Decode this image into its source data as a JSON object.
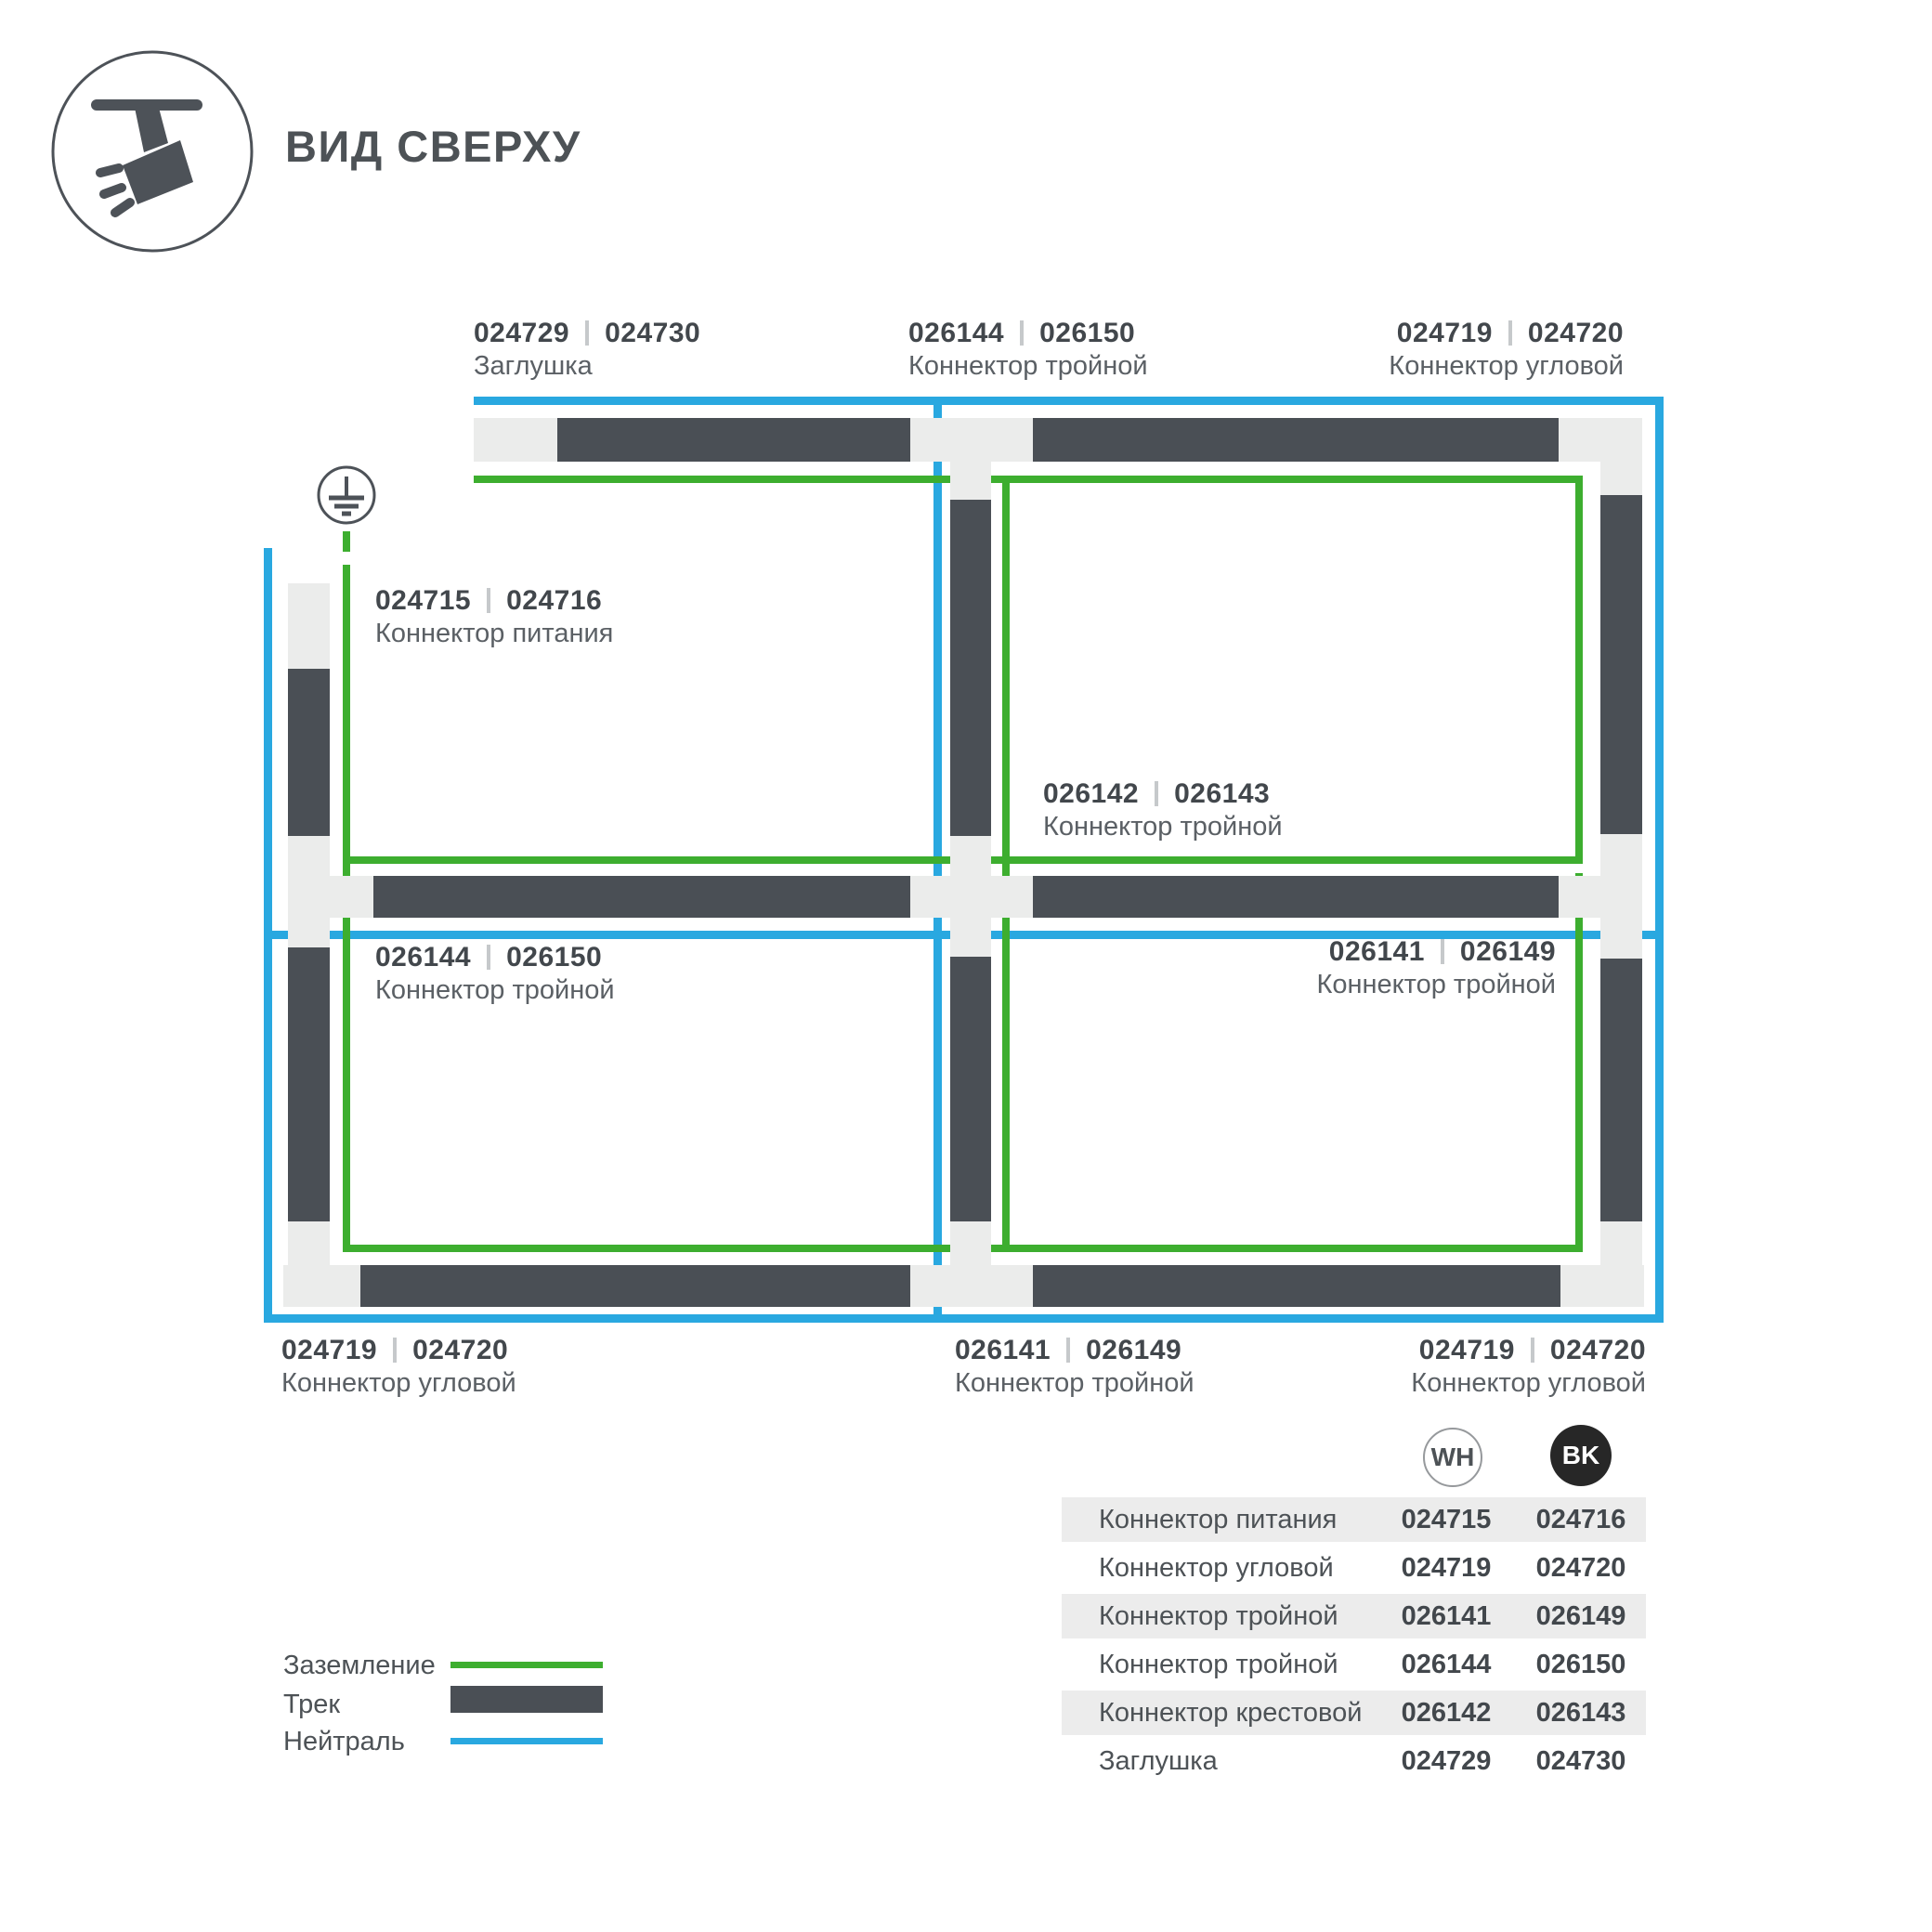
{
  "header": {
    "title": "ВИД СВЕРХУ"
  },
  "colors": {
    "blue": "#29a8e0",
    "green": "#3dae2f",
    "tdark": "#4a4f55",
    "tlight": "#ebeceb",
    "ink": "#4d5256",
    "code": "#42474c",
    "muted": "#5b6065",
    "sep": "#c6c9cb",
    "rowbg": "#ececec",
    "bk": "#272727"
  },
  "diagram": {
    "labels": [
      {
        "wh": "024729",
        "bk": "024730",
        "name": "Заглушка"
      },
      {
        "wh": "026144",
        "bk": "026150",
        "name": "Коннектор тройной"
      },
      {
        "wh": "024719",
        "bk": "024720",
        "name": "Коннектор угловой"
      },
      {
        "wh": "024715",
        "bk": "024716",
        "name": "Коннектор питания"
      },
      {
        "wh": "026142",
        "bk": "026143",
        "name": "Коннектор тройной"
      },
      {
        "wh": "026144",
        "bk": "026150",
        "name": "Коннектор тройной"
      },
      {
        "wh": "026141",
        "bk": "026149",
        "name": "Коннектор тройной"
      },
      {
        "wh": "024719",
        "bk": "024720",
        "name": "Коннектор угловой"
      },
      {
        "wh": "026141",
        "bk": "026149",
        "name": "Коннектор тройной"
      },
      {
        "wh": "024719",
        "bk": "024720",
        "name": "Коннектор угловой"
      }
    ]
  },
  "legend": {
    "items": [
      {
        "label": "Заземление"
      },
      {
        "label": "Трек"
      },
      {
        "label": "Нейтраль"
      }
    ]
  },
  "table": {
    "col_wh": "WH",
    "col_bk": "BK",
    "rows": [
      {
        "name": "Коннектор питания",
        "wh": "024715",
        "bk": "024716"
      },
      {
        "name": "Коннектор угловой",
        "wh": "024719",
        "bk": "024720"
      },
      {
        "name": "Коннектор тройной",
        "wh": "026141",
        "bk": "026149"
      },
      {
        "name": "Коннектор тройной",
        "wh": "026144",
        "bk": "026150"
      },
      {
        "name": "Коннектор крестовой",
        "wh": "026142",
        "bk": "026143"
      },
      {
        "name": "Заглушка",
        "wh": "024729",
        "bk": "024730"
      }
    ]
  }
}
